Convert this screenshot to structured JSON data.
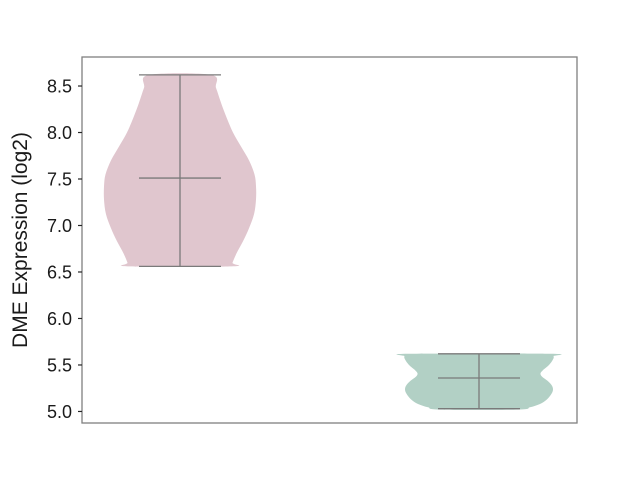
{
  "figure": {
    "background": "#ffffff",
    "plot_background": "#ffffff",
    "spine_color": "#808080",
    "tick_color": "#262626",
    "text_color": "#1a1a1a",
    "violin_line_color": "#7a7a7a"
  },
  "chart_data": {
    "type": "violin",
    "title": "",
    "xlabel": "",
    "ylabel": "DME Expression (log2)",
    "grid": false,
    "legend": null,
    "ylim": [
      4.876,
      8.812
    ],
    "yticks": [
      5.0,
      5.5,
      6.0,
      6.5,
      7.0,
      7.5,
      8.0,
      8.5
    ],
    "ytick_labels": [
      "5.0",
      "5.5",
      "6.0",
      "6.5",
      "7.0",
      "7.5",
      "8.0",
      "8.5"
    ],
    "xtick_labels": [],
    "series": [
      {
        "label": "left-violin",
        "fill_color": "#e0c6ce",
        "stats": {
          "min": 6.56,
          "max": 8.62,
          "median": 7.51
        },
        "profile": [
          [
            8.62,
            31
          ],
          [
            8.48,
            36
          ],
          [
            8.32,
            41
          ],
          [
            8.15,
            47
          ],
          [
            8.0,
            53
          ],
          [
            7.85,
            61
          ],
          [
            7.7,
            69
          ],
          [
            7.55,
            74.5
          ],
          [
            7.42,
            76
          ],
          [
            7.28,
            76
          ],
          [
            7.12,
            74
          ],
          [
            6.97,
            69
          ],
          [
            6.83,
            63
          ],
          [
            6.7,
            56.5
          ],
          [
            6.6,
            52.5
          ],
          [
            6.56,
            51.5
          ]
        ]
      },
      {
        "label": "right-violin",
        "fill_color": "#b2d0c5",
        "stats": {
          "min": 5.03,
          "max": 5.62,
          "median": 5.36
        },
        "profile": [
          [
            5.62,
            71
          ],
          [
            5.595,
            74.5
          ],
          [
            5.56,
            74
          ],
          [
            5.5,
            70
          ],
          [
            5.445,
            64
          ],
          [
            5.41,
            61.5
          ],
          [
            5.375,
            63
          ],
          [
            5.33,
            68.5
          ],
          [
            5.285,
            72.5
          ],
          [
            5.24,
            74
          ],
          [
            5.19,
            72.5
          ],
          [
            5.13,
            68
          ],
          [
            5.08,
            61
          ],
          [
            5.045,
            51
          ],
          [
            5.02,
            39
          ]
        ]
      }
    ]
  }
}
